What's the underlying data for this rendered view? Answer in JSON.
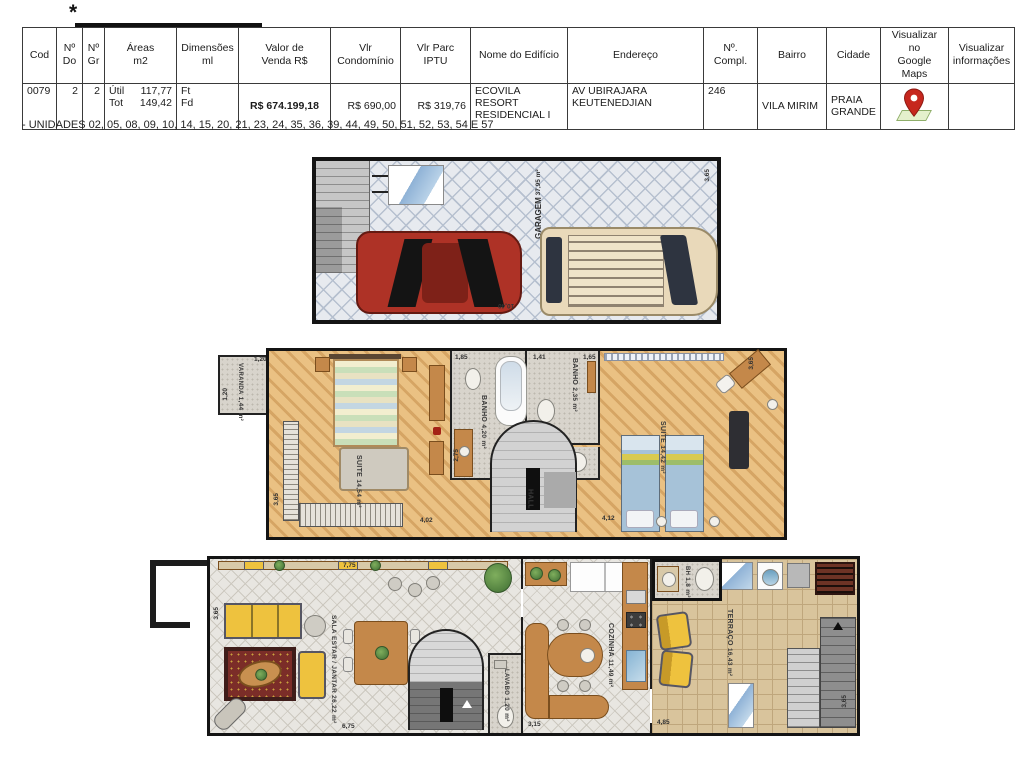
{
  "page": {
    "asterisk": "*",
    "footnote": "- UNIDADES 02, 05, 08, 09, 10, 14, 15, 20, 21, 23, 24, 35, 36, 39, 44, 49, 50, 51, 52, 53, 54 E 57"
  },
  "table": {
    "headers": {
      "cod": "Cod",
      "no_do": "Nº\nDo",
      "no_gr": "Nº\nGr",
      "areas": "Áreas\nm2",
      "dimensoes": "Dimensões\nml",
      "valor": "Valor de\nVenda R$",
      "condominio": "Vlr\nCondomínio",
      "iptu": "Vlr Parc IPTU",
      "edificio": "Nome do Edifício",
      "endereco": "Endereço",
      "compl": "Nº.\nCompl.",
      "bairro": "Bairro",
      "cidade": "Cidade",
      "maps": "Visualizar no\nGoogle Maps",
      "info": "Visualizar\ninformações"
    },
    "row": {
      "cod": "0079",
      "no_do": "2",
      "no_gr": "2",
      "util_label": "Útil",
      "util_value": "117,77",
      "tot_label": "Tot",
      "tot_value": "149,42",
      "dim_ft": "Ft",
      "dim_fd": "Fd",
      "valor": "R$ 674.199,18",
      "condominio": "R$ 690,00",
      "iptu": "R$ 319,76",
      "edificio": "ECOVILA RESORT RESIDENCIAL I",
      "endereco": "AV UBIRAJARA KEUTENEDJIAN",
      "compl": "246",
      "bairro": "VILA MIRIM",
      "cidade": "PRAIA GRANDE"
    }
  },
  "icons": {
    "maps_pin": "map-pin"
  },
  "plans": {
    "garage": {
      "room": "GARAGEM",
      "area": "37,95 m²",
      "dim_right": "3,65",
      "dim_bottom": "10,40"
    },
    "floor2": {
      "varanda": {
        "room": "VARANDA",
        "area": "1,44 m²",
        "dim_top": "1,20",
        "dim_side": "1,20"
      },
      "suite1": {
        "room": "SUITE",
        "area": "14,54 m²",
        "dim_side": "3,65",
        "dim_bottom": "4,02"
      },
      "banho1": {
        "room": "BANHO",
        "area": "4,20 m²",
        "dim_top": "1,85",
        "dim_side": "2,75"
      },
      "banho2": {
        "room": "BANHO",
        "area": "2,35 m²",
        "dim_a": "1,41",
        "dim_b": "1,65"
      },
      "hall": {
        "room": "HALL"
      },
      "suite2": {
        "room": "SUITE",
        "area": "14,42 m²",
        "dim_bottom": "4,12",
        "dim_side": "3,65"
      }
    },
    "floor1": {
      "sala": {
        "room1": "SALA",
        "room2": "ESTAR / JANTAR",
        "area": "26,22 m²",
        "dim_top": "7,75",
        "dim_side": "3,65",
        "dim_bottom": "6,75"
      },
      "lavabo": {
        "room": "LAVABO",
        "area": "1,20 m²"
      },
      "cozinha": {
        "room": "COZINHA",
        "area": "11,49 m²",
        "dim_bottom": "3,15"
      },
      "bh": {
        "room": "BH",
        "area": "1,8 m²"
      },
      "terraco": {
        "room": "TERRAÇO",
        "area": "16,43 m²",
        "dim_a": "4,85",
        "dim_b": "3,65"
      }
    }
  }
}
